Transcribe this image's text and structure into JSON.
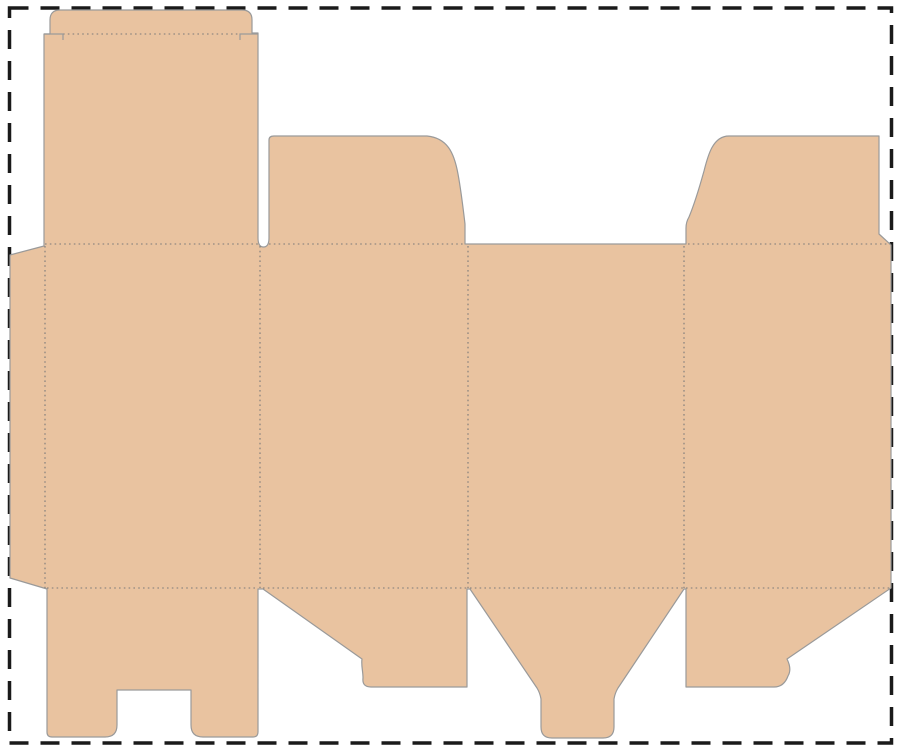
{
  "meta": {
    "description": "Die-cut packaging template (box dieline) with cut lines, dotted fold lines and a dashed page border"
  },
  "colors": {
    "background": "#ffffff",
    "cardboard": "#e9c3a0",
    "cut_line": "#9a9a9a",
    "fold_line": "#7a7a7a",
    "page_border": "#1a1a1a"
  },
  "parts": [
    "tuck-flap",
    "lid-panel",
    "glue-flap",
    "back-panel",
    "side-panel-left",
    "front-panel",
    "side-panel-right",
    "dust-flap-top-left",
    "dust-flap-top-right",
    "bottom-lock-flap-with-notch",
    "bottom-dust-flap-left",
    "bottom-tuck-tongue",
    "bottom-dust-flap-right"
  ],
  "counts": {
    "vertical_fold_lines": 4,
    "horizontal_fold_rows": 3
  }
}
